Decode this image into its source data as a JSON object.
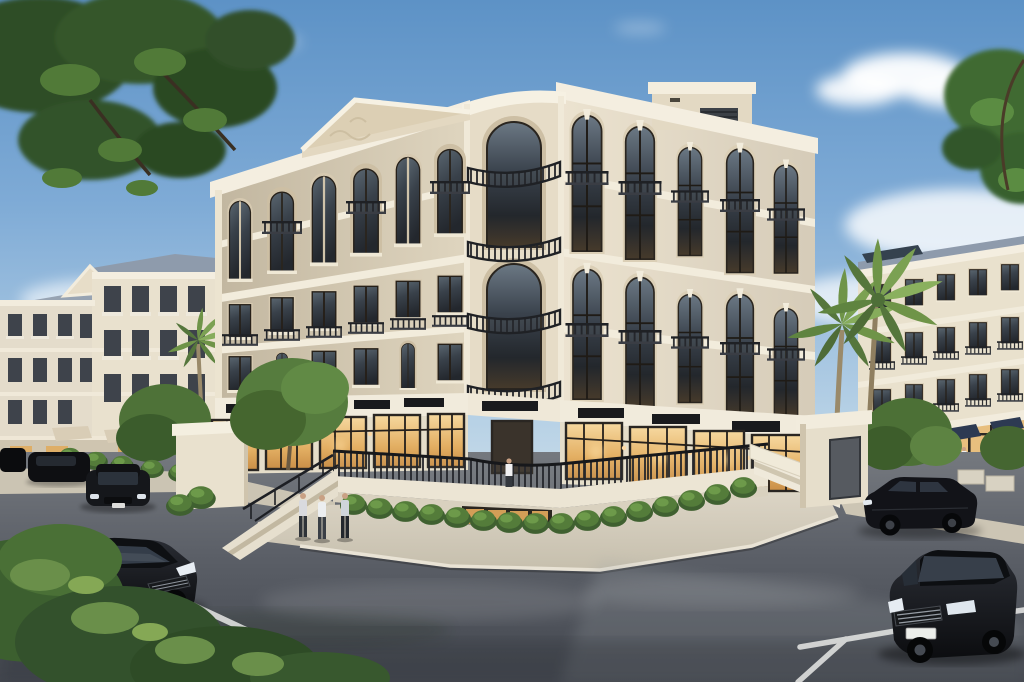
{
  "scene": {
    "alt": "Photorealistic dusk rendering of a five-level neoclassical cream stone apartment building on a street corner, with a pediment, tall arched windows, wrought-iron balconies, a curved corner loggia, warmly lit ground-floor shops behind an iron terrace railing, corner staircases, trimmed hedges, palm trees, similar classical buildings to the left and right, pedestrians on the plaza, and black sedans on wet asphalt streets under a blue sky with soft clouds",
    "setting": "street corner intersection",
    "lighting": "early evening warm interior lights, blue sky",
    "weather": "clear sky with scattered clouds, wet-looking pavement",
    "inventory": {
      "main_building_floors": 5,
      "shop_sign_boards": {
        "count": 9,
        "text": "illegible blank boards"
      },
      "cars_black": 6,
      "pedestrians_foreground": 3,
      "pedestrians_terrace": 1,
      "pedestrians_background": 3,
      "palm_trees": 3,
      "staircases": 2,
      "hedge_balls_row": 16,
      "road_markings_white_lines": 3,
      "background_buildings": 2,
      "utility_hut": 1
    }
  },
  "palette": {
    "sky_top": "#5d92c6",
    "sky_horizon": "#e2eaee",
    "cloud": "#ffffff",
    "facade_lit": "#ece3d0",
    "facade_shade": "#dfd5bf",
    "facade_corner": "#e6dcc7",
    "cornice": "#f4eee0",
    "recess": "#d6c9b0",
    "pediment_face": "#e3d8c1",
    "window_glass": "#353c44",
    "window_warm": "#e3aa5e",
    "storefront_warm": "#f0c989",
    "railing_iron": "#24262b",
    "sign_board": "#191a1d",
    "door_metal": "#565a60",
    "roof_slate": "#8e9bac",
    "solar_panel": "#35424f",
    "hedge_green": "#49702f",
    "hedge_highlight": "#6b9647",
    "tree_green": "#3c6130",
    "tree_dark": "#2c4a23",
    "palm_green": "#7ba152",
    "trunk_brown": "#9a8a6a",
    "plaza_stone": "#d3ccbc",
    "curb_light": "#e9e3d5",
    "sidewalk": "#cbc4b3",
    "asphalt": "#62666e",
    "asphalt_dark": "#4a4e56",
    "road_marking": "#e3e4e2",
    "car_black": "#131519",
    "wall_cream": "#e9e1ce",
    "awning_navy": "#2d3a52",
    "skin": "#c9a184"
  }
}
